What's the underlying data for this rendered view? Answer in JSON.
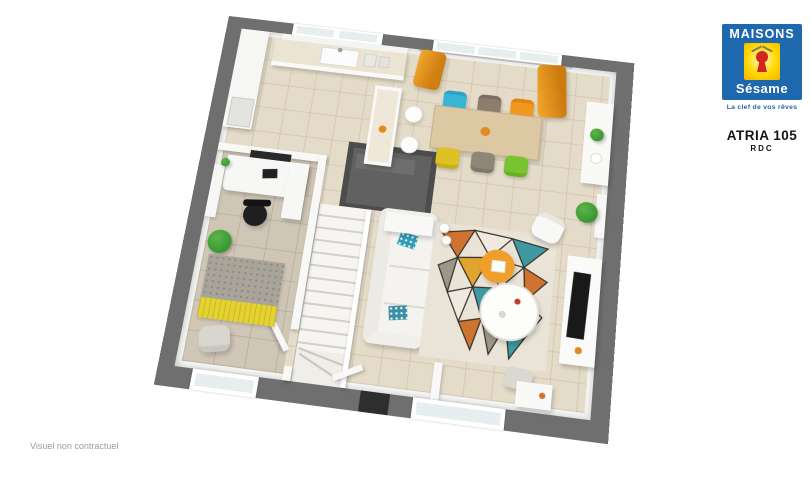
{
  "page": {
    "background": "#ffffff"
  },
  "logo": {
    "line1": "MAISONS",
    "line2": "Sésame",
    "tagline": "La clef de vos rêves",
    "colors": {
      "blue": "#1e68ae",
      "yellow": "#ffd800",
      "keyhole_red": "#d2261c"
    }
  },
  "header": {
    "model": "ATRIA 105",
    "level": "RDC"
  },
  "footer": {
    "disclaimer": "Visuel non contractuel"
  },
  "floorplan": {
    "type": "3d-top-down-floor-plan",
    "rooms": [
      "kitchen",
      "dining-area",
      "living-room",
      "office",
      "entrance-hall",
      "staircase",
      "storage-closet"
    ],
    "colors": {
      "exterior_wall": "#6f6f6f",
      "interior_wall": "#f8f8f6",
      "floor_main": "#e4dbc8",
      "floor_office": "#cfc6b6",
      "closet_wall": "#4c4c4c",
      "curtain_orange": "#e8941f",
      "chair_teal": "#39b5d6",
      "chair_taupe": "#8d7d6f",
      "chair_orange": "#f0971e",
      "chair_yellow": "#ddc226",
      "chair_gray": "#8e8779",
      "chair_green": "#79c330",
      "table_wood": "#dcc8a2",
      "sofa_white": "#f4f3f0",
      "rug_accents": [
        "#cf7430",
        "#3f98a2",
        "#e0a42f",
        "#9c958a"
      ],
      "tv_black": "#191919",
      "office_rug_gray": "#a9a49a",
      "office_rug_yellow": "#e6d22f",
      "plant_green": "#3f9e35"
    }
  }
}
